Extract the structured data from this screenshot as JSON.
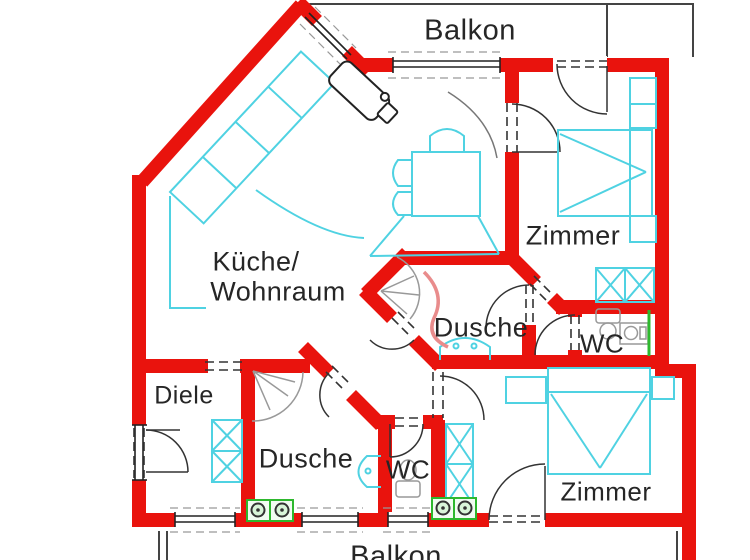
{
  "plan": {
    "type": "apartment-floor-plan",
    "language": "de"
  },
  "labels": {
    "balkon_top": "Balkon",
    "zimmer_top_right": "Zimmer",
    "kueche_line1": "Küche/",
    "kueche_line2": "Wohnraum",
    "dusche_upper": "Dusche",
    "wc_upper": "WC",
    "diele": "Diele",
    "dusche_lower": "Dusche",
    "wc_lower": "WC",
    "zimmer_bottom_right": "Zimmer",
    "balkon_bottom": "Balkon"
  },
  "colors": {
    "wall_red": "#e9130d",
    "furniture_cyan": "#4fd2e2",
    "fixture_green": "#2eb82e",
    "fixture_gray": "#999999",
    "shower_curve_pink": "#e98c8c",
    "text": "#262626",
    "outline_black": "#444444"
  },
  "icons": [
    "bed-icon",
    "wardrobe-icon",
    "nightstand-icon",
    "dining-table-icon",
    "chair-icon",
    "kitchen-counter-icon",
    "kitchen-appliance-icon",
    "shower-icon",
    "toilet-icon",
    "sink-icon",
    "washer-icon",
    "radiator-line-icon",
    "door-swing-icon",
    "window-icon"
  ]
}
